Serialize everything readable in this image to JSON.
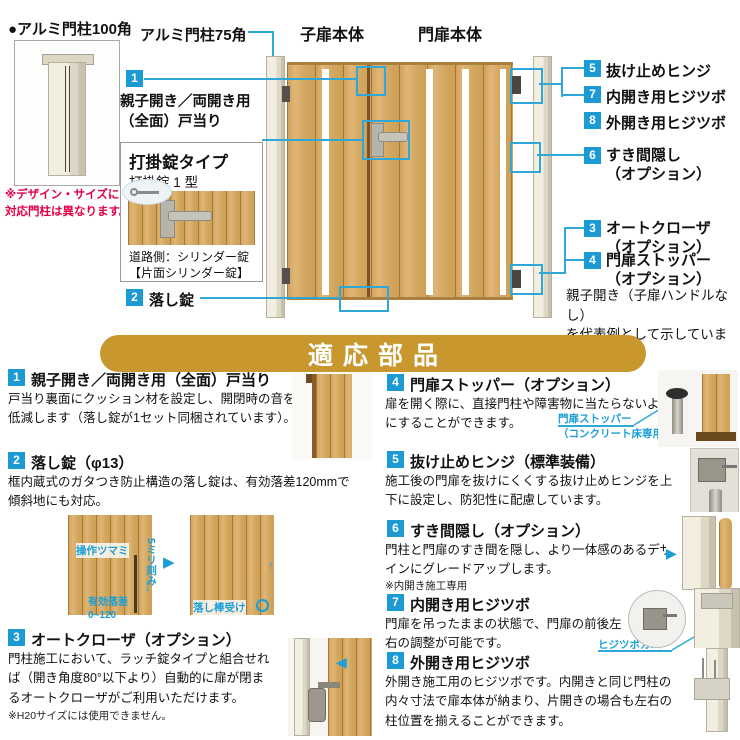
{
  "top": {
    "post100_label": "●アルミ門柱100角",
    "post100_note": "※デザイン・サイズによって\n対応門柱は異なります。",
    "post75_label": "アルミ門柱75角",
    "child_door_label": "子扉本体",
    "main_door_label": "門扉本体",
    "callout1": {
      "num": "1",
      "label": "親子開き／両開き用\n（全面）戸当り"
    },
    "callout2": {
      "num": "2",
      "label": "落し錠"
    },
    "lock": {
      "title": "打掛錠タイプ",
      "subtitle": "打掛錠 1 型",
      "roadside": "道路側：シリンダー錠\n【片面シリンダー錠】"
    },
    "right_callouts": [
      {
        "num": "5",
        "label": "抜け止めヒンジ"
      },
      {
        "num": "7",
        "label": "内開き用ヒジツボ"
      },
      {
        "num": "8",
        "label": "外開き用ヒジツボ"
      },
      {
        "num": "6",
        "label": "すき間隠し\n（オプション）"
      },
      {
        "num": "3",
        "label": "オートクローザ\n（オプション）"
      },
      {
        "num": "4",
        "label": "門扉ストッパー\n（オプション）"
      }
    ],
    "example_note": "親子開き（子扉ハンドルなし）\nを代表例として示しています。"
  },
  "banner": {
    "title": "適応部品"
  },
  "parts": [
    {
      "num": "1",
      "title": "親子開き／両開き用（全面）戸当り",
      "desc": "戸当り裏面にクッション材を設定し、開閉時の音を低減します（落し錠が1セット同梱されています）。"
    },
    {
      "num": "2",
      "title": "落し錠（φ13）",
      "desc": "框内蔵式のガタつき防止構造の落し錠は、有効落差120mmで傾斜地にも対応。",
      "label_knob": "操作ツマミ",
      "label_pitch": "5ミリ刻み",
      "label_drop": "有効落差\n0~120",
      "label_receiver": "落し棒受け"
    },
    {
      "num": "3",
      "title": "オートクローザ（オプション）",
      "desc": "門柱施工において、ラッチ錠タイプと組合せれば（開き角度80°以下より）自動的に扉が閉まるオートクローザがご利用いただけます。",
      "note": "※H20サイズには使用できません。"
    },
    {
      "num": "4",
      "title": "門扉ストッパー（オプション）",
      "desc": "扉を開く際に、直接門柱や障害物に当たらないようにすることができます。",
      "label": "門扉ストッパー\n（コンクリート床専用）"
    },
    {
      "num": "5",
      "title": "抜け止めヒンジ（標準装備）",
      "desc": "施工後の門扉を抜けにくくする抜け止めヒンジを上下に設定し、防犯性に配慮しています。"
    },
    {
      "num": "6",
      "title": "すき間隠し（オプション）",
      "desc": "門柱と門扉のすき間を隠し、より一体感のあるデザインにグレードアップします。",
      "note": "※内開き施工専用"
    },
    {
      "num": "7",
      "title": "内開き用ヒジツボ",
      "desc": "門扉を吊ったままの状態で、門扉の前後左右の調整が可能です。",
      "label": "ヒジツボカバー"
    },
    {
      "num": "8",
      "title": "外開き用ヒジツボ",
      "desc": "外開き施工用のヒジツボです。内開きと同じ門柱の内々寸法で扉本体が納まり、片開きの場合も左右の柱位置を揃えることができます。"
    }
  ],
  "colors": {
    "accent_blue": "#1b9ad3",
    "line_cyan": "#2fa8d8",
    "banner_gold": "#c8982e",
    "note_red": "#e60045",
    "cyan_label": "#1a9fd8"
  }
}
